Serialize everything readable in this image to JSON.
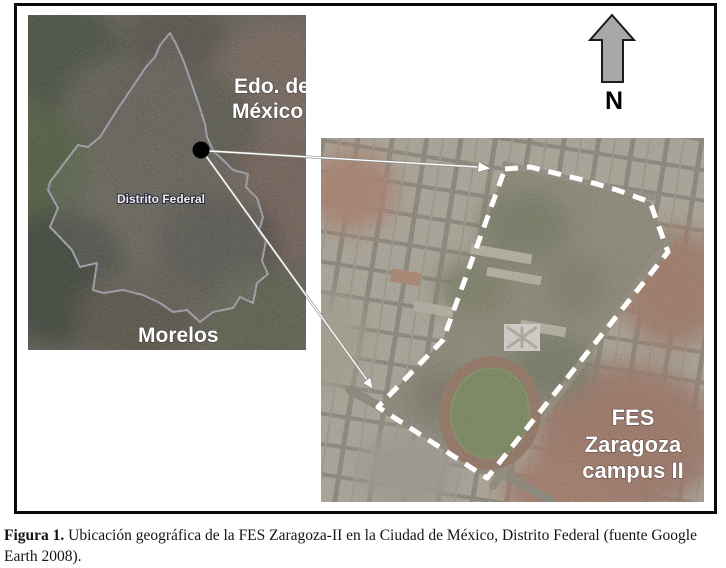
{
  "caption": {
    "label": "Figura 1.",
    "text": "Ubicación geográfica de la FES Zaragoza-II en la Ciudad de México, Distrito Federal (fuente Google Earth 2008)."
  },
  "north": {
    "label": "N"
  },
  "left_map": {
    "region_top_right": {
      "line1": "Edo. de",
      "line2": "México"
    },
    "region_center": "Distrito Federal",
    "region_bottom": "Morelos"
  },
  "right_map": {
    "campus": {
      "line1": "FES",
      "line2": "Zaragoza",
      "line3": "campus II"
    }
  },
  "colors": {
    "state_boundary": "#dcd9f2",
    "campus_outline": "#ffffff",
    "marker": "#000000",
    "north_arrow": "#a8a8a8"
  }
}
